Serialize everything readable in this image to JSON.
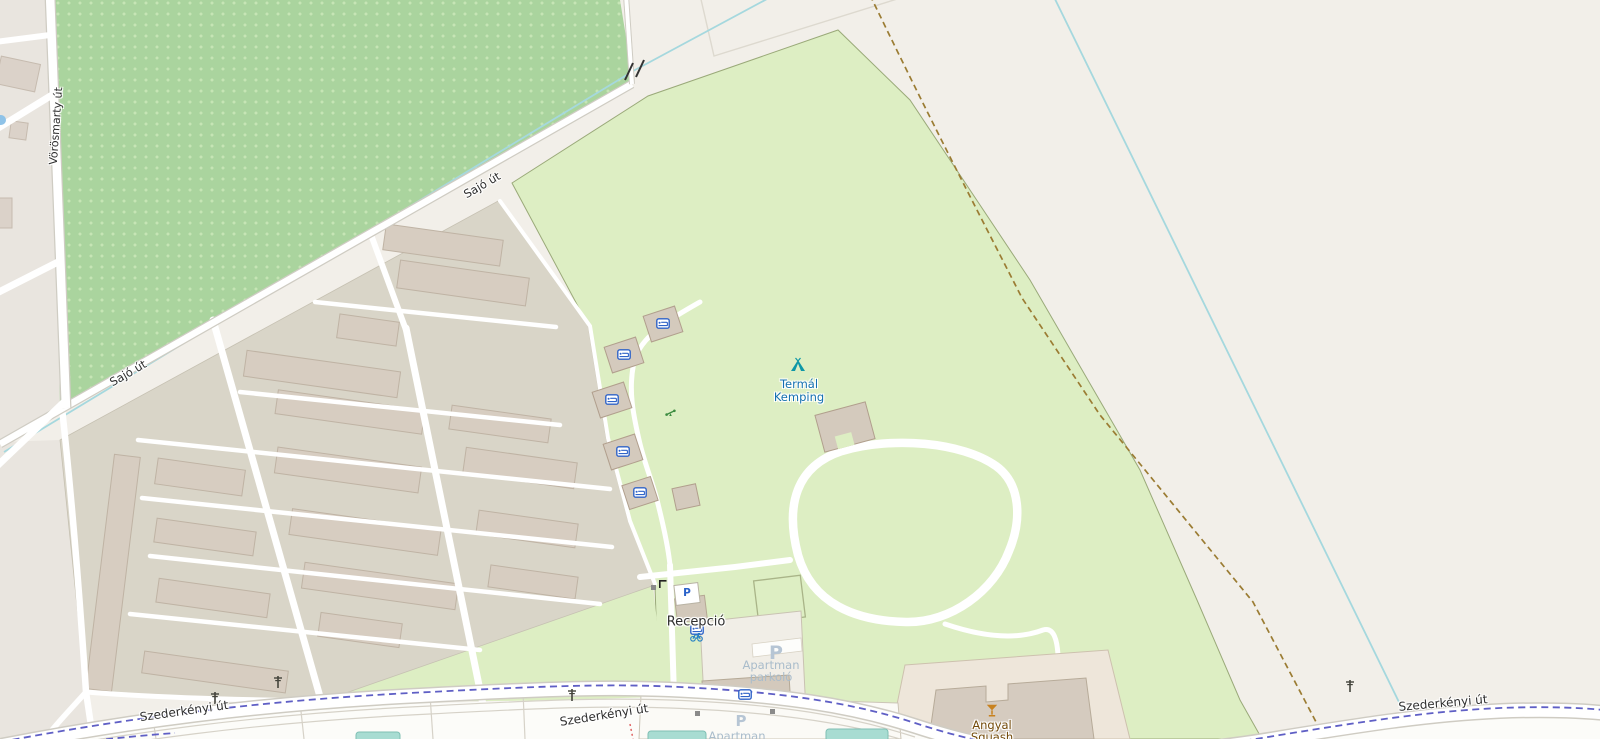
{
  "roads": {
    "sajo": "Sajó út",
    "vorosmarty": "Vörösmarty út",
    "szederkenyi": "Szederkényi út"
  },
  "pois": {
    "campsite": {
      "line1": "Termál",
      "line2": "Kemping"
    },
    "reception": {
      "label": "Recepció"
    },
    "apartman_parking": {
      "line1": "Apartman",
      "line2": "parkoló",
      "partial": "Apartman"
    },
    "bar": {
      "line1": "Angyal",
      "line2": "Squash"
    },
    "parking_letter": "P"
  },
  "icons": [
    "tent-icon",
    "bed-icon",
    "bicycle-icon",
    "playground-icon",
    "cocktail-icon",
    "power-pole-icon",
    "gate-icon",
    "barrier-icon",
    "bridge-icon",
    "water-icon",
    "parking-icon"
  ],
  "colors": {
    "background": "#f2efe9",
    "orchard_green": "#aad49e",
    "orchard_dot": "#c6e5b5",
    "camp_green": "#ddeec3",
    "farm_ground": "#d9d5c8",
    "residential": "#e9e5df",
    "building": "#d7cdc1",
    "road_white": "#ffffff",
    "stream_blue": "#a5d8de",
    "route_dash_purple": "#5f5fc5",
    "track_dash_brown": "#9b7c33",
    "poi_blue_text": "#1470b0",
    "parking_text": "#a9bccb",
    "bar_text_brown": "#734a08",
    "bed_icon_blue": "#2f63c8",
    "tent_icon_teal": "#0e97a7",
    "cocktail_orange": "#c8821f",
    "playground_green": "#3c8c40",
    "pool_teal": "#a8dcd2"
  }
}
